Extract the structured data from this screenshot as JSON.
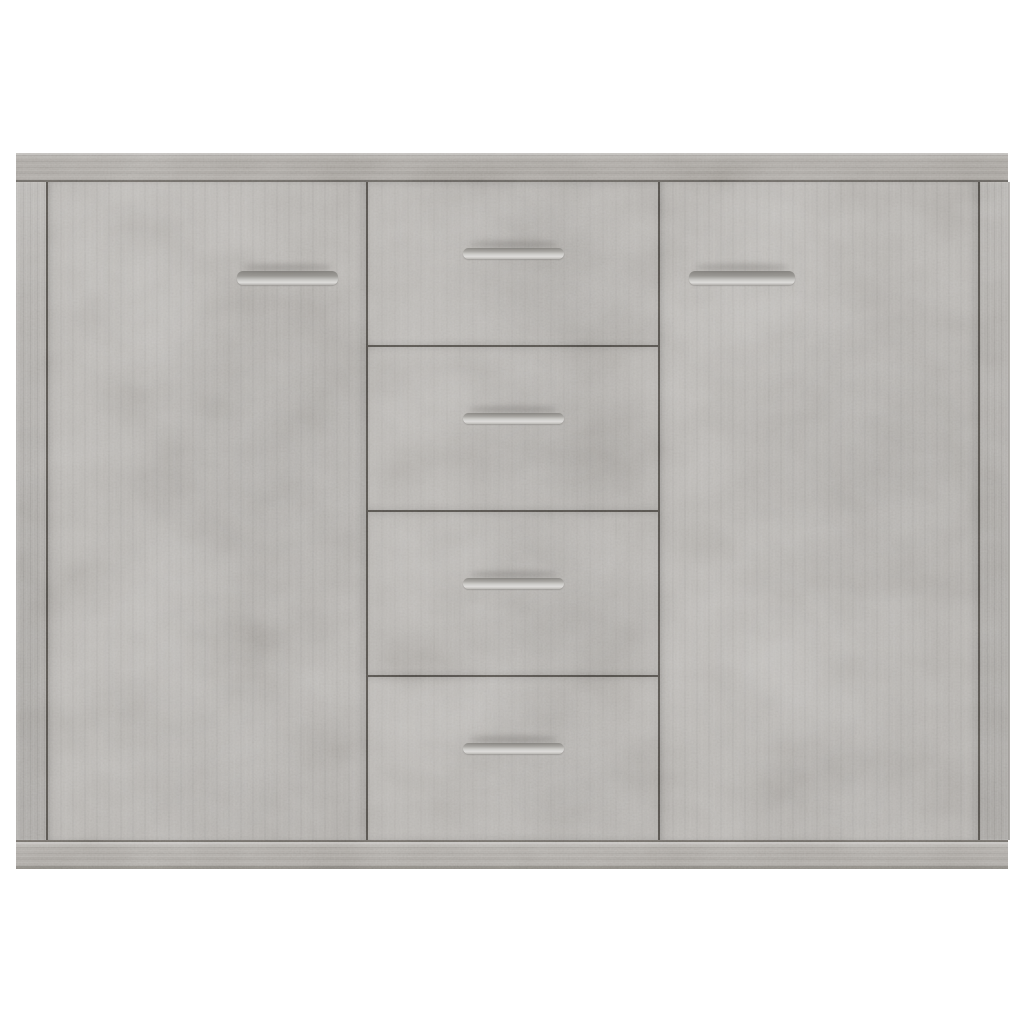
{
  "scene": {
    "type": "product-photo",
    "subject": "Sideboard in concrete grey",
    "description": "Front view of a concrete-grey engineered-wood sideboard on a plain white background: two full-height doors flanking a centre column of four drawers, each with a slim horizontal metal bar handle, topped by a woodgrain top panel and standing on a matching base plinth",
    "visible_text": ""
  },
  "sideboard": {
    "material": "concrete grey engineered wood",
    "top_panel": {
      "name": "top panel"
    },
    "base_panel": {
      "name": "base plinth"
    },
    "left_side_panel": {
      "name": "left side panel"
    },
    "right_side_panel": {
      "name": "right side panel"
    },
    "left_door": {
      "name": "left door",
      "handle": "horizontal metal bar handle"
    },
    "right_door": {
      "name": "right door",
      "handle": "horizontal metal bar handle"
    },
    "drawers": [
      {
        "name": "drawer 1",
        "handle": "horizontal metal bar handle"
      },
      {
        "name": "drawer 2",
        "handle": "horizontal metal bar handle"
      },
      {
        "name": "drawer 3",
        "handle": "horizontal metal bar handle"
      },
      {
        "name": "drawer 4",
        "handle": "horizontal metal bar handle"
      }
    ]
  },
  "colors": {
    "background": "#ffffff",
    "panel_face": "#b0ada9",
    "panel_shade": "#a19e9a",
    "trim": "#a5a19c",
    "side_panel": "#a9a6a2",
    "seam": "#514e4a",
    "handle_dark": "#8f8d89",
    "handle_light": "#dedddb"
  }
}
